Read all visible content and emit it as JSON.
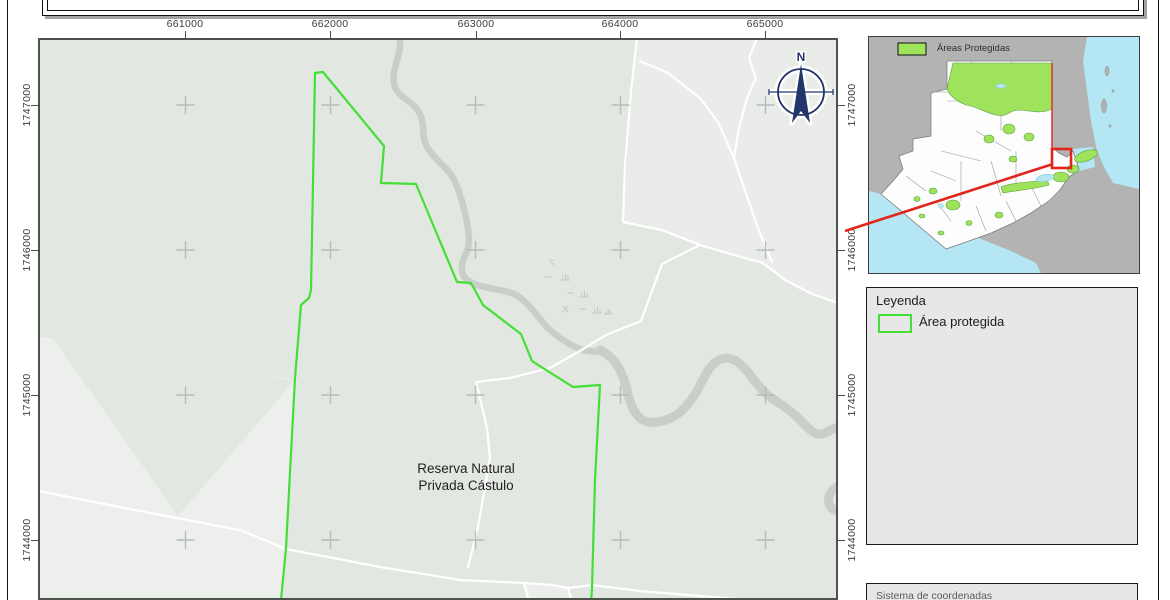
{
  "page": {
    "background": "#ffffff",
    "border_color": "#141414"
  },
  "main_map": {
    "place_label_line1": "Reserva Natural",
    "place_label_line2": "Privada Cástulo",
    "north_label": "N",
    "grid_top_labels": [
      "661000",
      "662000",
      "663000",
      "664000",
      "665000"
    ],
    "grid_left_labels": [
      "1747000",
      "1746000",
      "1745000",
      "1744000"
    ],
    "grid_right_labels": [
      "1747000",
      "1746000",
      "1745000",
      "1744000"
    ],
    "colors": {
      "background": "#e3e7e2",
      "light_parcel": "#edefec",
      "river": "#c9cec9",
      "road": "#ffffff",
      "protected_area_outline": "#43df34",
      "grid_cross": "#b7bcb8",
      "north_arrow": "#23356b",
      "frame": "#4d524d"
    }
  },
  "inset_map": {
    "legend_label": "Áreas Protegidas",
    "colors": {
      "neighbor_land": "#b3b3b3",
      "country_fill": "#fdfdfd",
      "sea": "#b5e6f3",
      "protected_fill": "#9fe35c",
      "protected_border": "#57a23f",
      "highlight_red": "#e1251b",
      "frame": "#3c3c3c"
    }
  },
  "legend_box": {
    "title": "Leyenda",
    "item_label": "Área protegida",
    "background": "#e7e7e7"
  },
  "footer_box": {
    "text": "Sistema de coordenadas",
    "background": "#e7e7e7"
  }
}
